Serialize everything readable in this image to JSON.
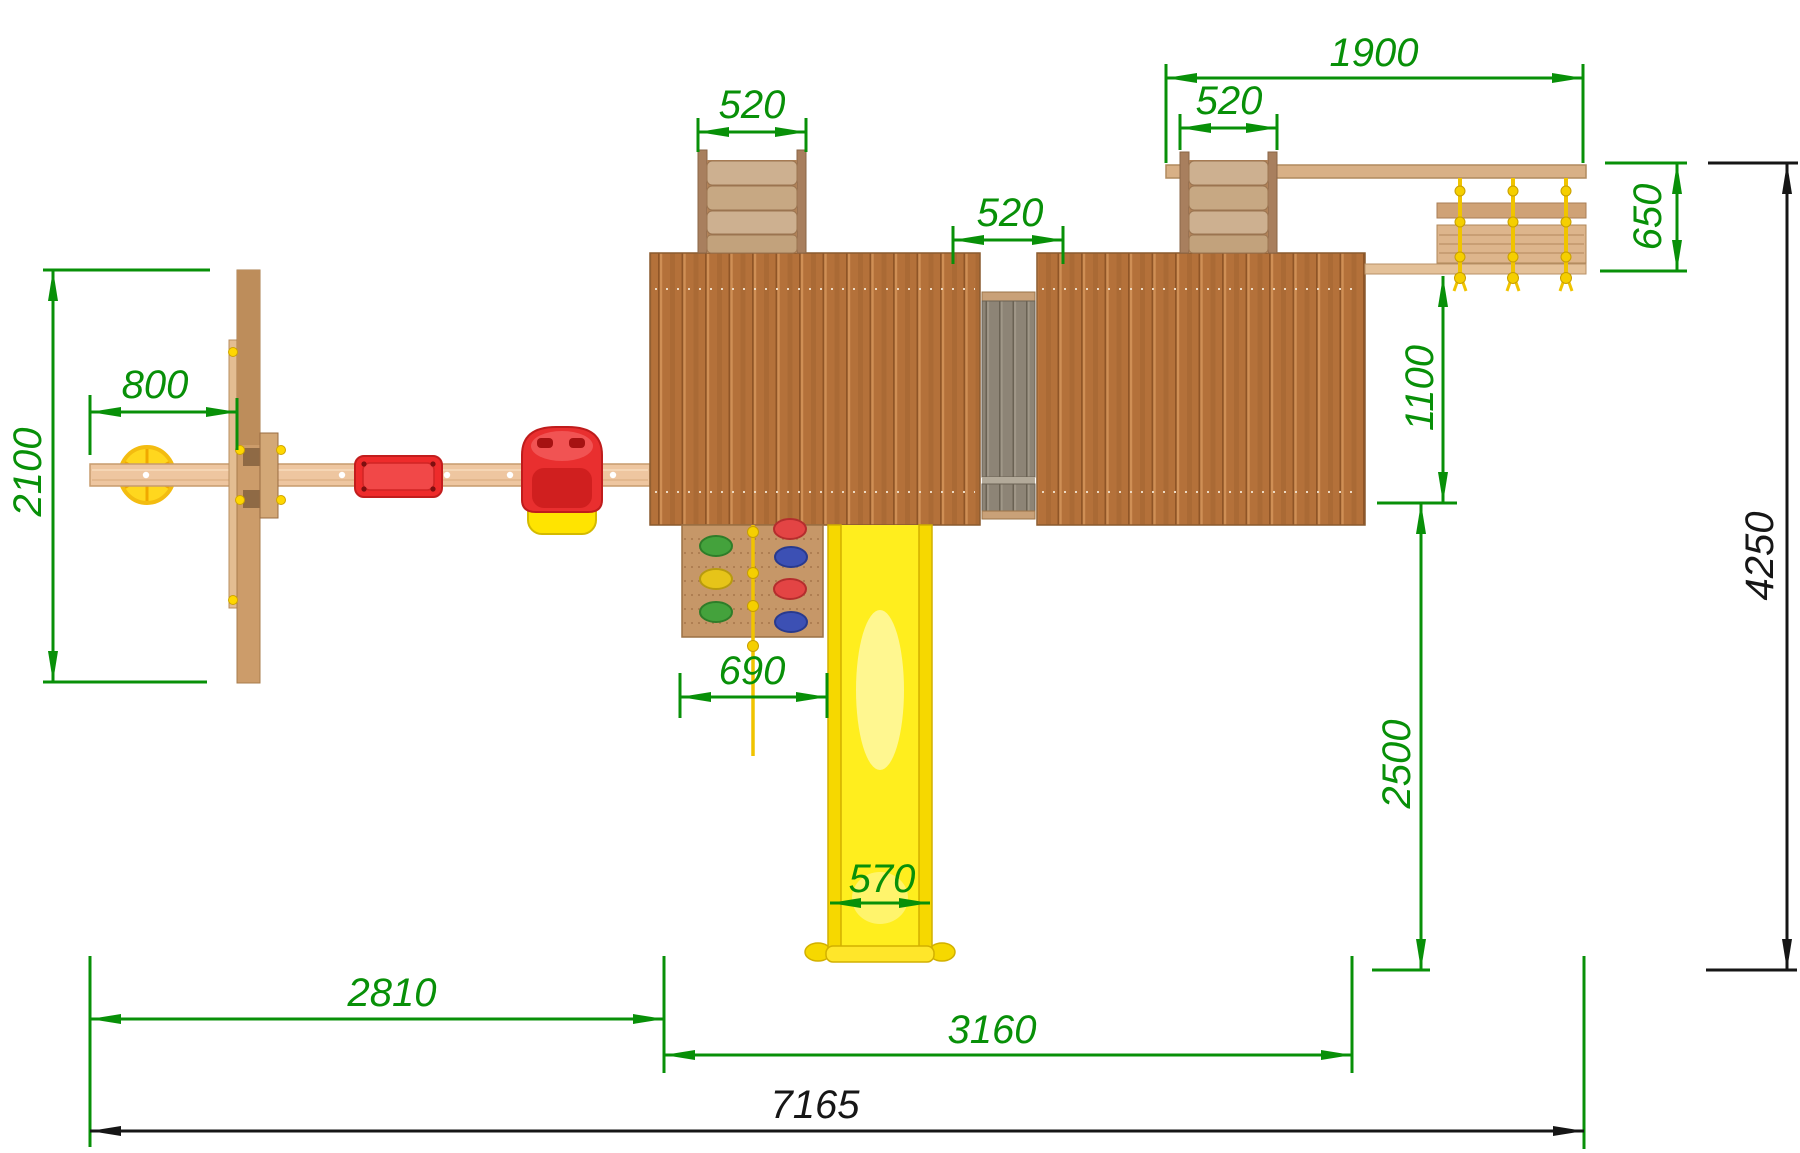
{
  "drawing": {
    "type": "playground-top-view-plan",
    "colors": {
      "dimension_accent": "#089008",
      "dimension_dark": "#161616",
      "roof_wood": "#b4713a",
      "ladder_wood": "#cdb090",
      "beam_wood": "#eec6a0",
      "bridge_gray": "#8d8476",
      "slide_yellow": "#ffee1e",
      "rope_yellow": "#f0c400",
      "seat_red": "#e92f2f",
      "swing_disc_yellow": "#ffd71e"
    },
    "dimensions": {
      "top_beam_span": {
        "label": "1900",
        "orientation": "horizontal"
      },
      "left_ladder_width": {
        "label": "520",
        "orientation": "horizontal"
      },
      "middle_bridge_width": {
        "label": "520",
        "orientation": "horizontal"
      },
      "right_ladder_width": {
        "label": "520",
        "orientation": "horizontal"
      },
      "rope_bridge_depth": {
        "label": "650",
        "orientation": "vertical"
      },
      "bridge_to_tower": {
        "label": "1100",
        "orientation": "vertical"
      },
      "swing_depth": {
        "label": "2100",
        "orientation": "vertical"
      },
      "swing_overhang": {
        "label": "800",
        "orientation": "horizontal"
      },
      "climbing_wall_width": {
        "label": "690",
        "orientation": "horizontal"
      },
      "slide_width": {
        "label": "570",
        "orientation": "horizontal"
      },
      "tower_to_front": {
        "label": "2500",
        "orientation": "vertical"
      },
      "total_depth": {
        "label": "4250",
        "orientation": "vertical"
      },
      "swing_section_length": {
        "label": "2810",
        "orientation": "horizontal"
      },
      "tower_section_length": {
        "label": "3160",
        "orientation": "horizontal"
      },
      "total_length": {
        "label": "7165",
        "orientation": "horizontal"
      }
    }
  }
}
